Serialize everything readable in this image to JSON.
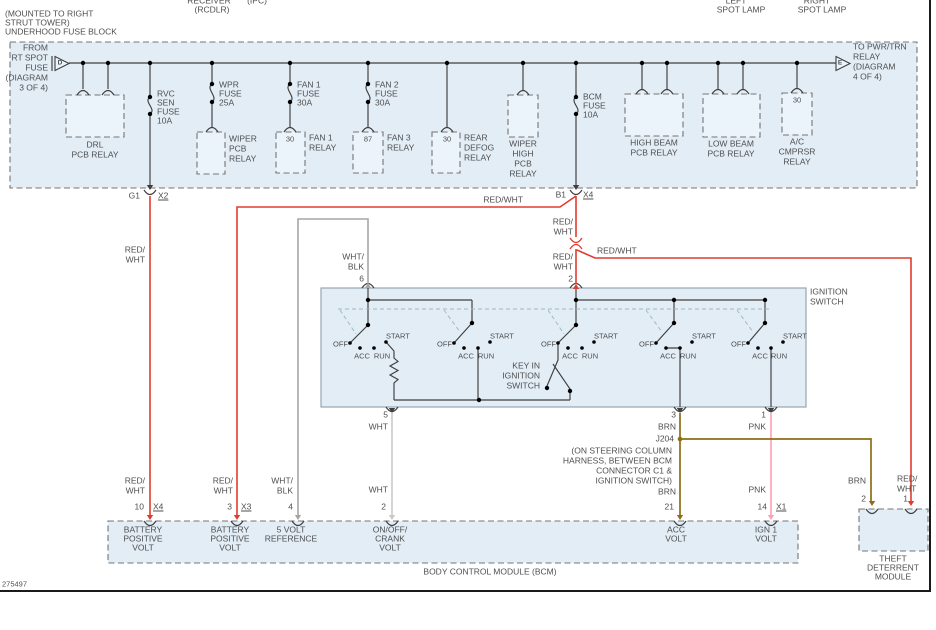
{
  "header": {
    "m1": "(MOUNTED TO RIGHT",
    "m2": "STRUT TOWER)",
    "m3": "UNDERHOOD FUSE BLOCK",
    "receiver1": "RECEIVER",
    "receiver2": "(RCDLR)",
    "ipc": "(IPC)",
    "left1": "LEFT",
    "left2": "SPOT LAMP",
    "right1": "RIGHT",
    "right2": "SPOT LAMP"
  },
  "fb": {
    "entry": [
      "FROM",
      "RT SPOT",
      "FUSE",
      "(DIAGRAM",
      "3 OF 4)"
    ],
    "entry_letter": "D",
    "exit": [
      "TO PWR/TRN",
      "RELAY",
      "(DIAGRAM",
      "4 OF 4)"
    ],
    "exit_letter": "E",
    "drl": [
      "DRL",
      "PCB RELAY"
    ],
    "rvc": [
      "RVC",
      "SEN",
      "FUSE",
      "10A"
    ],
    "wpr": [
      "WPR",
      "FUSE",
      "25A"
    ],
    "wiper_pcb": [
      "WIPER",
      "PCB",
      "RELAY"
    ],
    "fan1_fuse": [
      "FAN 1",
      "FUSE",
      "30A"
    ],
    "fan1_relay": [
      "FAN 1",
      "RELAY"
    ],
    "fan2_fuse": [
      "FAN 2",
      "FUSE",
      "30A"
    ],
    "fan3_relay": [
      "FAN 3",
      "RELAY"
    ],
    "defog": [
      "REAR",
      "DEFOG",
      "RELAY"
    ],
    "wiper_high": [
      "WIPER",
      "HIGH",
      "PCB",
      "RELAY"
    ],
    "bcm_fuse": [
      "BCM",
      "FUSE",
      "10A"
    ],
    "high_beam": [
      "HIGH BEAM",
      "PCB RELAY"
    ],
    "low_beam": [
      "LOW BEAM",
      "PCB RELAY"
    ],
    "ac": [
      "A/C",
      "CMPRSR",
      "RELAY"
    ],
    "t30": "30",
    "t87": "87",
    "g1": "G1",
    "x2": "X2",
    "b1": "B1",
    "x4": "X4"
  },
  "wires": {
    "redwht": "RED/WHT",
    "red1": "RED/",
    "red2": "WHT",
    "wb1": "WHT/",
    "wb2": "BLK",
    "wht": "WHT",
    "brn": "BRN",
    "pnk": "PNK",
    "j204": "J204",
    "note": [
      "(ON STEERING COLUMN",
      "HARNESS, BETWEEN BCM",
      "CONNECTOR C1 &",
      "IGNITION SWITCH)"
    ]
  },
  "ign": {
    "title": [
      "IGNITION",
      "SWITCH"
    ],
    "pos": {
      "off": "OFF",
      "acc": "ACC",
      "run": "RUN",
      "start": "START"
    },
    "key": [
      "KEY IN",
      "IGNITION",
      "SWITCH"
    ],
    "p6": "6",
    "p2": "2",
    "p5": "5",
    "p3": "3",
    "p1": "1"
  },
  "bcm": {
    "title": "BODY CONTROL MODULE (BCM)",
    "p10": "10",
    "x4": "X4",
    "p3": "3",
    "x3": "X3",
    "p4": "4",
    "p2": "2",
    "p21": "21",
    "p14": "14",
    "x1": "X1",
    "bat1": [
      "BATTERY",
      "POSITIVE",
      "VOLT"
    ],
    "bat2": [
      "BATTERY",
      "POSITIVE",
      "VOLT"
    ],
    "ref": [
      "5 VOLT",
      "REFERENCE"
    ],
    "crank": [
      "ON/OFF/",
      "CRANK",
      "VOLT"
    ],
    "acc": [
      "ACC",
      "VOLT"
    ],
    "ign1": [
      "IGN 1",
      "VOLT"
    ]
  },
  "tdm": {
    "title": [
      "THEFT",
      "DETERRENT",
      "MODULE"
    ],
    "p2": "2",
    "p1": "1"
  },
  "footer": {
    "doc": "275497"
  },
  "colors": {
    "red": "#e23b2e",
    "pink": "#ff9fb2",
    "brn": "#8d6e17",
    "wht": "#c9c9c9",
    "wb": "#a6a6a6",
    "line": "#3f3f3f",
    "fill": "#e2edf6",
    "fill-inner": "#ebf4fa",
    "dash": "#757575",
    "text": "#4f4f4f"
  }
}
